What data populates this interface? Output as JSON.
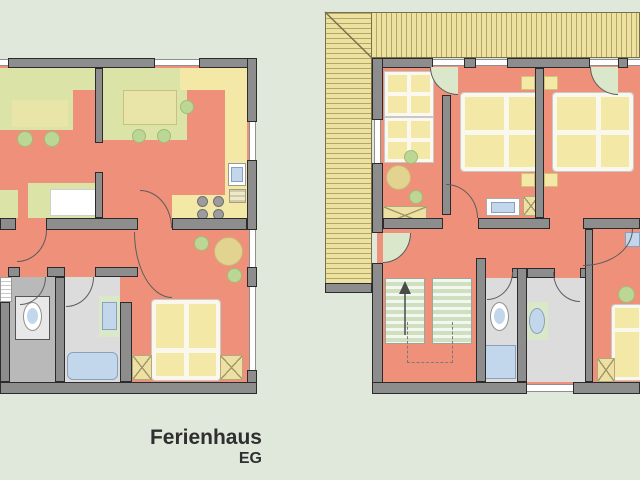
{
  "caption": {
    "title": "Ferienhaus",
    "floor": "EG"
  },
  "colors": {
    "background": "#dfe8da",
    "floor": "#ef907a",
    "wall": "#8d8d8d",
    "outline": "#2b2b2b",
    "furniture_green": "#dbe3a6",
    "furniture_yellow": "#f4e8a6",
    "bath_floor": "#dcdcdc",
    "wc_floor": "#b9b9b9",
    "fixture_blue": "#c3d7ec",
    "plant_green": "#bcd795",
    "table_tan": "#e3d390",
    "roof": "#ece19f",
    "stairs_green": "#cfe0c0"
  }
}
